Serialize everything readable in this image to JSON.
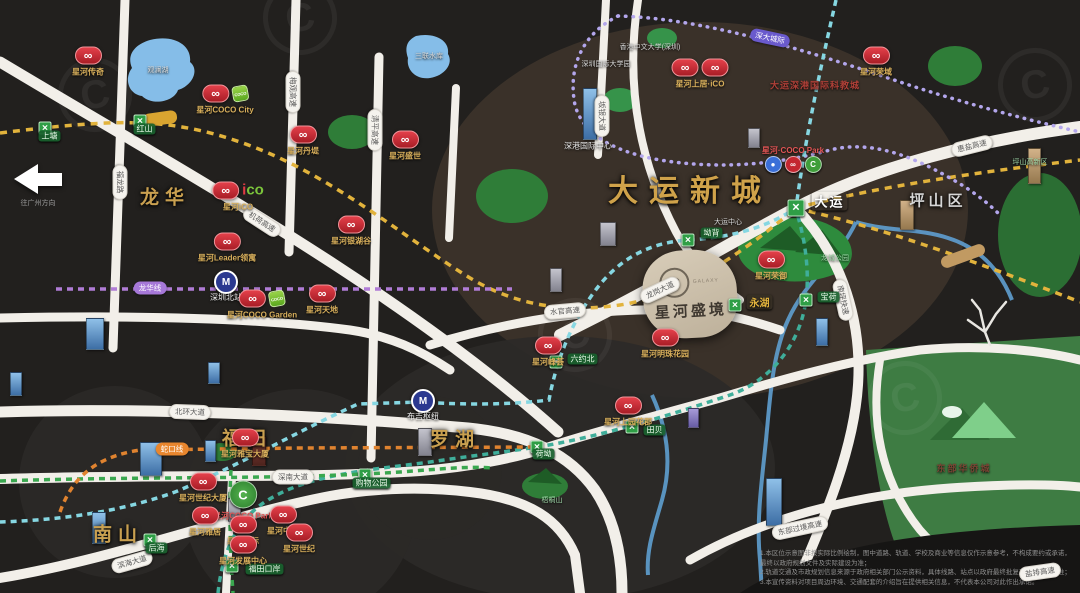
{
  "icons": {
    "chain": "∞",
    "station_x": "✕",
    "hub": "M",
    "coco_c": "C",
    "coco_text": "COCO"
  },
  "project": {
    "name": "星河盛境",
    "logo_letter": "C",
    "logo_caption": "GALAXY"
  },
  "arrow": {
    "caption": "往广州方向"
  },
  "districts": [
    {
      "label": "龙华",
      "x": 165,
      "y": 196
    },
    {
      "label": "福田",
      "x": 247,
      "y": 437
    },
    {
      "label": "南山",
      "x": 118,
      "y": 533
    },
    {
      "label": "罗湖",
      "x": 455,
      "y": 438
    },
    {
      "label": "大运新城",
      "x": 690,
      "y": 188,
      "cls": "big"
    },
    {
      "label": "坪山区",
      "x": 938,
      "y": 200,
      "cls": "gray"
    }
  ],
  "area_labels": [
    {
      "label": "观澜湖",
      "x": 158,
      "y": 70,
      "cls": ""
    },
    {
      "label": "三联水库",
      "x": 429,
      "y": 56,
      "cls": ""
    },
    {
      "label": "深港国际中心",
      "x": 588,
      "y": 146,
      "cls": "white8"
    },
    {
      "label": "大运深港国际科教城",
      "x": 815,
      "y": 85,
      "cls": "red"
    },
    {
      "label": "香港中文大学(深圳)",
      "x": 650,
      "y": 47,
      "cls": ""
    },
    {
      "label": "深圳国际大学园",
      "x": 606,
      "y": 64,
      "cls": ""
    },
    {
      "label": "大运中心",
      "x": 728,
      "y": 222,
      "cls": ""
    },
    {
      "label": "龙城公园",
      "x": 835,
      "y": 258,
      "cls": "green"
    },
    {
      "label": "梧桐山",
      "x": 552,
      "y": 500,
      "cls": "green"
    },
    {
      "label": "东部华侨城",
      "x": 964,
      "y": 468,
      "cls": "brown"
    },
    {
      "label": "坪山高新区",
      "x": 1030,
      "y": 162,
      "cls": "green"
    }
  ],
  "road_pills": [
    {
      "text": "福龙路",
      "x": 120,
      "y": 182,
      "rot": 90
    },
    {
      "text": "梅观高速",
      "x": 293,
      "y": 92,
      "rot": 90
    },
    {
      "text": "清平高速",
      "x": 375,
      "y": 130,
      "rot": 90
    },
    {
      "text": "坂银大道",
      "x": 602,
      "y": 116,
      "rot": 90
    },
    {
      "text": "机荷高速",
      "x": 262,
      "y": 222,
      "rot": 33
    },
    {
      "text": "水官高速",
      "x": 565,
      "y": 311,
      "rot": -5
    },
    {
      "text": "龙岗大道",
      "x": 660,
      "y": 290,
      "rot": -25
    },
    {
      "text": "南坪快速",
      "x": 843,
      "y": 300,
      "rot": 78
    },
    {
      "text": "惠盐高速",
      "x": 972,
      "y": 146,
      "rot": -14
    },
    {
      "text": "北环大道",
      "x": 190,
      "y": 412,
      "rot": 2
    },
    {
      "text": "深南大道",
      "x": 293,
      "y": 477,
      "rot": 0
    },
    {
      "text": "滨海大道",
      "x": 132,
      "y": 562,
      "rot": -16
    },
    {
      "text": "东部过境高速",
      "x": 800,
      "y": 528,
      "rot": -12
    },
    {
      "text": "盐排高速",
      "x": 1040,
      "y": 572,
      "rot": -8
    }
  ],
  "metro_pills": [
    {
      "text": "龙华线",
      "x": 150,
      "y": 288,
      "rot": 0,
      "bg": "#a678d8"
    },
    {
      "text": "深大城际",
      "x": 770,
      "y": 38,
      "rot": 12,
      "bg": "#6a5acd"
    },
    {
      "text": "蛇口线",
      "x": 172,
      "y": 449,
      "rot": 0,
      "bg": "#e8862e"
    }
  ],
  "stations": [
    {
      "name": "大运",
      "x": 796,
      "y": 208,
      "big": true,
      "style": "plain",
      "dx": 14,
      "dy": -8
    },
    {
      "name": "坳背",
      "x": 688,
      "y": 240,
      "dx": 9,
      "dy": -6
    },
    {
      "name": "永湖",
      "x": 735,
      "y": 305,
      "style": "gold",
      "dx": 8,
      "dy": -4
    },
    {
      "name": "荷坳",
      "x": 537,
      "y": 447,
      "dx": -8,
      "dy": 8
    },
    {
      "name": "六约北",
      "x": 556,
      "y": 362,
      "dx": 8,
      "dy": -2
    },
    {
      "name": "宝荷",
      "x": 806,
      "y": 300,
      "dx": 8,
      "dy": -2
    },
    {
      "name": "上塘",
      "x": 45,
      "y": 128,
      "dx": -10,
      "dy": 9
    },
    {
      "name": "红山",
      "x": 140,
      "y": 121,
      "dx": -10,
      "dy": 9
    },
    {
      "name": "购物公园",
      "x": 365,
      "y": 475,
      "dx": -16,
      "dy": 9
    },
    {
      "name": "福田口岸",
      "x": 232,
      "y": 566,
      "dx": 10,
      "dy": 4
    },
    {
      "name": "后海",
      "x": 150,
      "y": 540,
      "dx": -8,
      "dy": 9
    },
    {
      "name": "田贝",
      "x": 632,
      "y": 427,
      "dx": 8,
      "dy": 4
    }
  ],
  "hubs": [
    {
      "name": "深圳北站",
      "x": 226,
      "y": 282
    },
    {
      "name": "布吉枢纽",
      "x": 423,
      "y": 401
    }
  ],
  "badges": [
    {
      "label": "星河传奇",
      "x": 88,
      "y": 62
    },
    {
      "label": "星河COCO City",
      "x": 225,
      "y": 100,
      "green": true
    },
    {
      "label": "星河丹堤",
      "x": 303,
      "y": 141
    },
    {
      "label": "星河盛世",
      "x": 405,
      "y": 146
    },
    {
      "label": "星河iCO",
      "x": 238,
      "y": 197,
      "variant": "ico"
    },
    {
      "label": "星河Leader领寓",
      "x": 227,
      "y": 248
    },
    {
      "label": "星河银湖谷",
      "x": 351,
      "y": 231
    },
    {
      "label": "星河天地",
      "x": 322,
      "y": 300
    },
    {
      "label": "星河COCO Garden",
      "x": 262,
      "y": 305,
      "green": true
    },
    {
      "label": "星河上居·iCO",
      "x": 700,
      "y": 74,
      "double": true
    },
    {
      "label": "星河·COCO Park",
      "x": 793,
      "y": 158,
      "variant": "cocopark"
    },
    {
      "label": "星河荣御",
      "x": 771,
      "y": 266
    },
    {
      "label": "星河明珠花园",
      "x": 665,
      "y": 344
    },
    {
      "label": "星河峰荟",
      "x": 548,
      "y": 352
    },
    {
      "label": "星河上园花郡",
      "x": 628,
      "y": 412
    },
    {
      "label": "星河雅宝大厦",
      "x": 245,
      "y": 444
    },
    {
      "label": "星河世纪大厦",
      "x": 203,
      "y": 488
    },
    {
      "label": "星河COCO Park",
      "x": 243,
      "y": 501,
      "variant": "cocopark-big"
    },
    {
      "label": "星河雅居",
      "x": 205,
      "y": 522
    },
    {
      "label": "星河国际",
      "x": 243,
      "y": 531
    },
    {
      "label": "星河中心",
      "x": 283,
      "y": 521
    },
    {
      "label": "星河世纪",
      "x": 299,
      "y": 539
    },
    {
      "label": "星河发展中心",
      "x": 243,
      "y": 551
    },
    {
      "label": "星河荣域",
      "x": 876,
      "y": 62
    }
  ],
  "buildings": [
    {
      "x": 583,
      "y": 88,
      "w": 12,
      "h": 50,
      "c": "blue"
    },
    {
      "x": 550,
      "y": 268,
      "w": 10,
      "h": 22,
      "c": "gray"
    },
    {
      "x": 86,
      "y": 318,
      "w": 16,
      "h": 30,
      "c": "blue"
    },
    {
      "x": 10,
      "y": 372,
      "w": 10,
      "h": 22,
      "c": "blue"
    },
    {
      "x": 140,
      "y": 442,
      "w": 20,
      "h": 32,
      "c": "blue"
    },
    {
      "x": 92,
      "y": 512,
      "w": 12,
      "h": 30,
      "c": "blue"
    },
    {
      "x": 208,
      "y": 362,
      "w": 10,
      "h": 20,
      "c": "blue"
    },
    {
      "x": 228,
      "y": 498,
      "w": 11,
      "h": 22,
      "c": "gray"
    },
    {
      "x": 418,
      "y": 428,
      "w": 12,
      "h": 26,
      "c": "gray"
    },
    {
      "x": 600,
      "y": 222,
      "w": 14,
      "h": 22,
      "c": "gray"
    },
    {
      "x": 748,
      "y": 128,
      "w": 10,
      "h": 18,
      "c": "gray"
    },
    {
      "x": 900,
      "y": 200,
      "w": 12,
      "h": 28,
      "c": "tan"
    },
    {
      "x": 1028,
      "y": 148,
      "w": 11,
      "h": 34,
      "c": "tan"
    },
    {
      "x": 766,
      "y": 478,
      "w": 14,
      "h": 46,
      "c": "blue"
    },
    {
      "x": 816,
      "y": 318,
      "w": 10,
      "h": 26,
      "c": "blue"
    },
    {
      "x": 688,
      "y": 408,
      "w": 9,
      "h": 18,
      "c": "purple"
    },
    {
      "x": 252,
      "y": 436,
      "w": 12,
      "h": 28,
      "c": "darkred"
    },
    {
      "x": 205,
      "y": 440,
      "w": 9,
      "h": 20,
      "c": "blue"
    }
  ],
  "disclaimer": {
    "lines": [
      "1.本区位示意图非按实际比例绘制，图中道路、轨道、学校及商业等信息仅作示意参考，不构成要约或承诺，最终以政府规划文件及实际建设为准；",
      "2.轨道交通及市政规划信息来源于政府相关部门公示资料，具体线路、站点以政府最终批复及实际建成为准；",
      "3.本宣传资料对项目周边环境、交通配套的介绍旨在提供相关信息，不代表本公司对此作出承诺。"
    ]
  }
}
